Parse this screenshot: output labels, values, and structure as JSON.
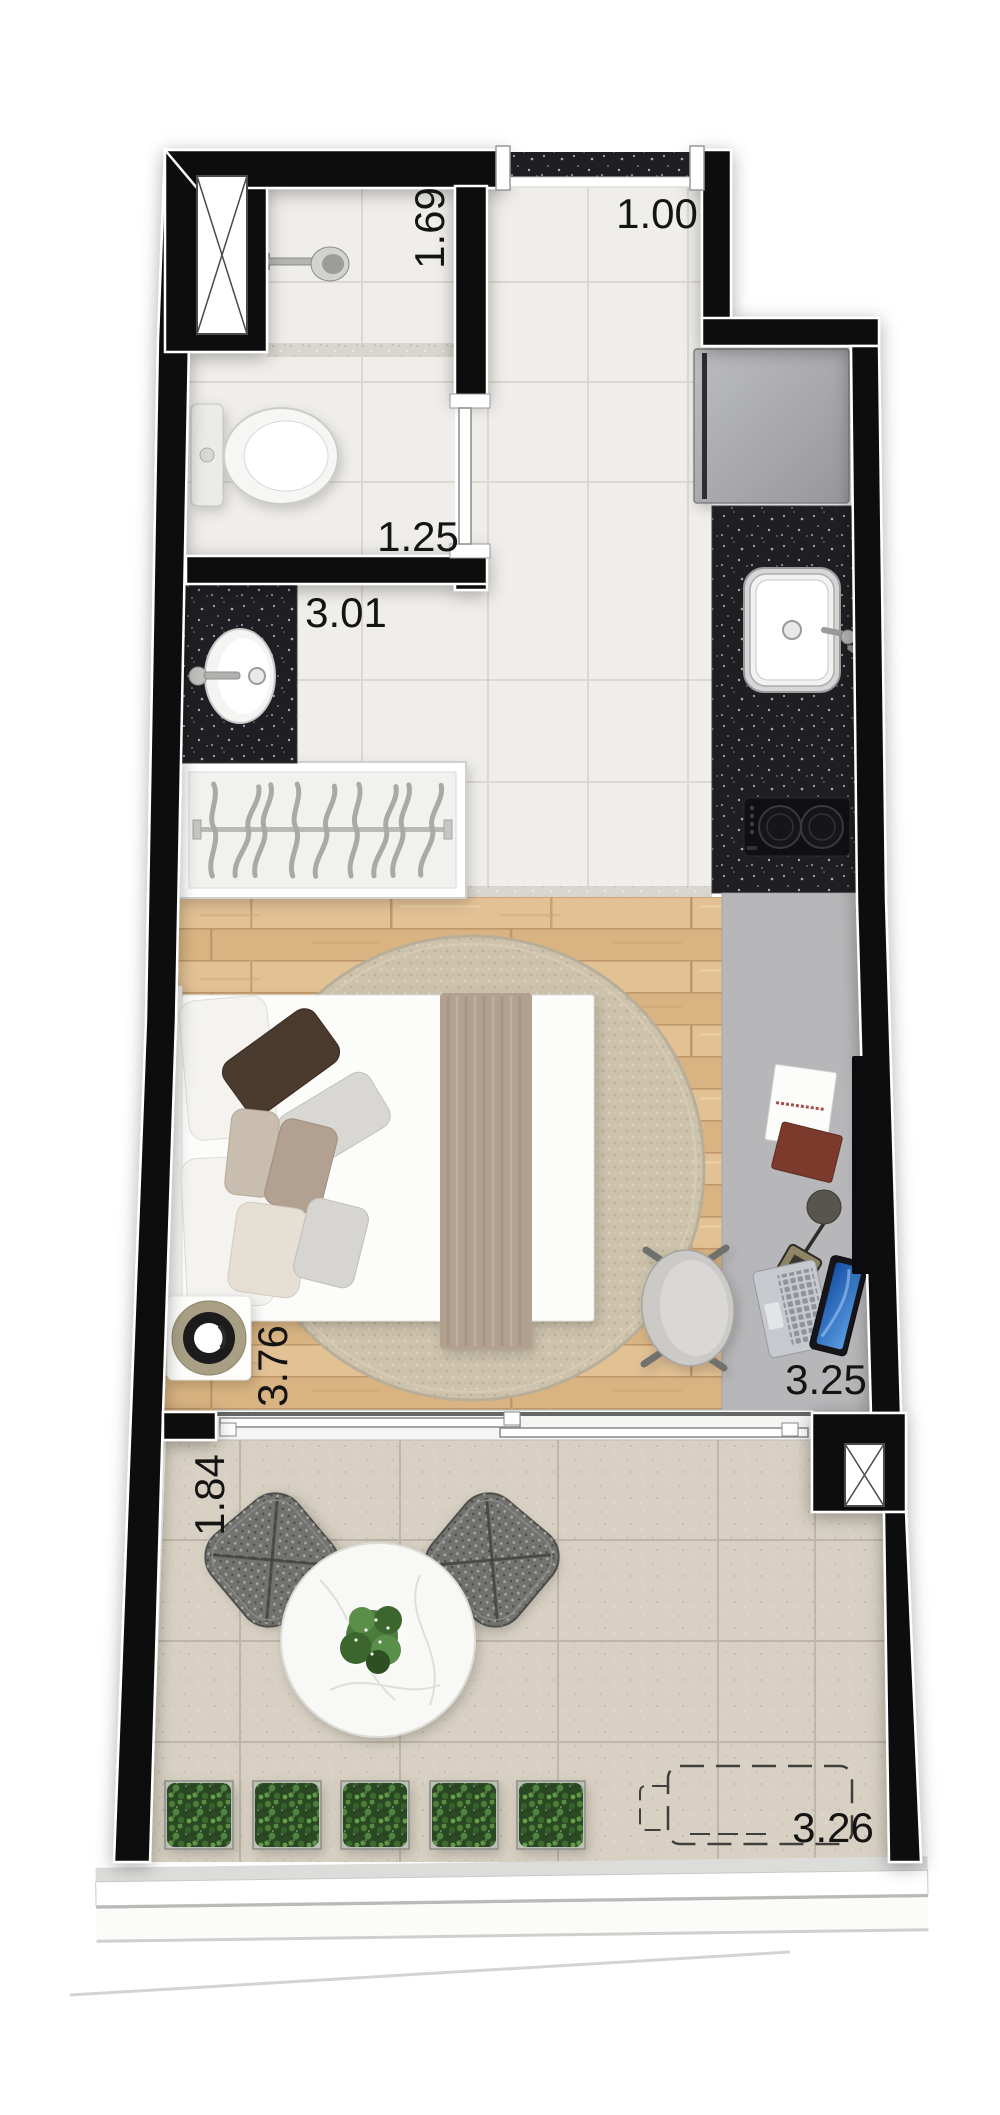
{
  "labels": {
    "entry_opening": {
      "value": "1.00",
      "orientation": "horizontal",
      "area": "entry"
    },
    "shower": {
      "value": "1.69",
      "orientation": "vertical",
      "area": "shower"
    },
    "bathroom": {
      "value": "1.25",
      "orientation": "horizontal",
      "area": "bathroom"
    },
    "hall": {
      "value": "3.01",
      "orientation": "horizontal",
      "area": "hall"
    },
    "bedroom": {
      "value": "3.76",
      "orientation": "vertical",
      "area": "bedroom"
    },
    "desk_wall": {
      "value": "3.25",
      "orientation": "horizontal",
      "area": "desk-side"
    },
    "balcony_depth": {
      "value": "1.84",
      "orientation": "vertical",
      "area": "balcony"
    },
    "balcony_width": {
      "value": "3.26",
      "orientation": "horizontal",
      "area": "balcony"
    }
  },
  "colors": {
    "wall": "#0b0b0d",
    "tile_floor": "#f0eeea",
    "wood_floor": "#ddba8c",
    "granite_counter": "#202024",
    "balcony_floor": "#d8d1c3",
    "rug": "#cdc3ad",
    "desk": "#b7b7b9",
    "refrigerator": "#a9aaac",
    "plant_green": "#4a7d38",
    "label_text": "#141414"
  },
  "fixtures": [
    "entrance-threshold",
    "service-shaft",
    "shower-head",
    "toilet",
    "vanity-sink",
    "wardrobe-closet",
    "refrigerator",
    "kitchen-counter",
    "kitchen-sink",
    "cooktop",
    "wall-tv",
    "desk",
    "notebook",
    "book",
    "desk-lamp",
    "laptop",
    "desk-chair",
    "double-bed",
    "pillows",
    "throw-blanket",
    "round-rug",
    "floor-speaker",
    "sliding-glass-door",
    "balcony-table",
    "outdoor-chairs",
    "planter-boxes",
    "ac-unit-outline",
    "glass-railing"
  ]
}
